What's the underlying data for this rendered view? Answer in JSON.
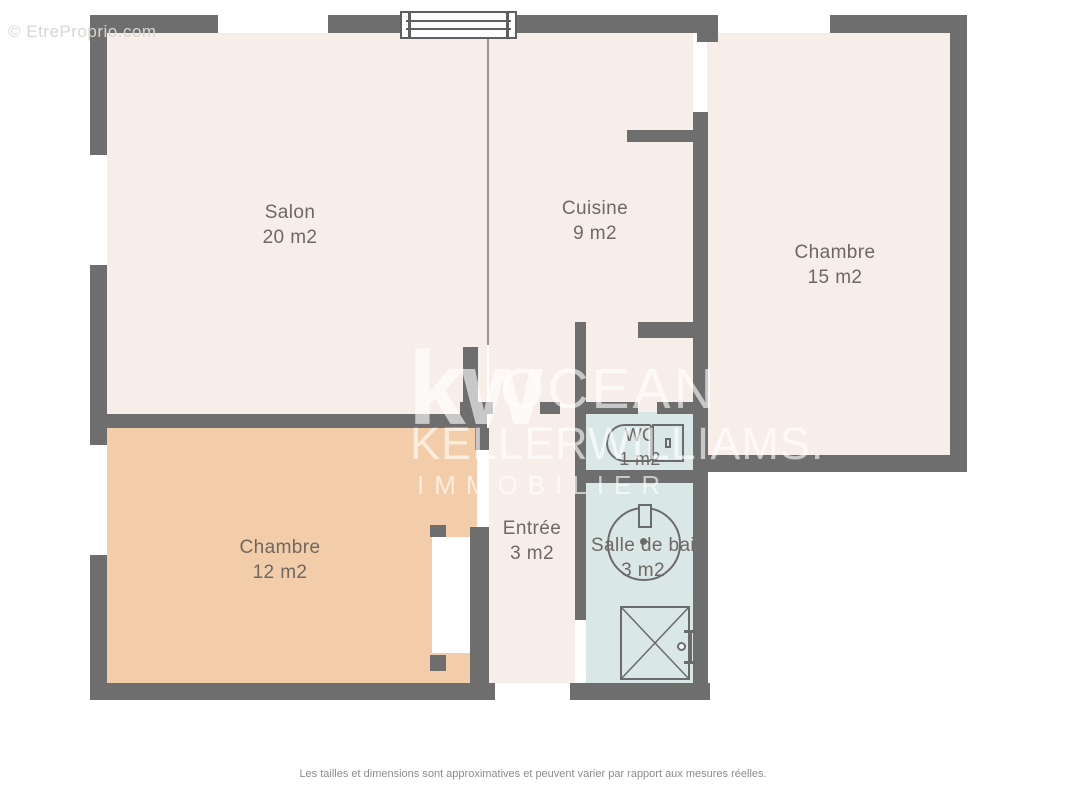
{
  "page": {
    "credit_watermark": "© EtreProprio.com",
    "disclaimer": "Les tailles et dimensions sont approximatives et peuvent varier par rapport aux mesures réelles."
  },
  "brand": {
    "kw": "kw",
    "line1": "OCEAN",
    "line2": "KELLERWILLIAMS.",
    "line3": "IMMOBILIER"
  },
  "rooms": [
    {
      "id": "salon",
      "label": "Salon",
      "area": "20 m2"
    },
    {
      "id": "cuisine",
      "label": "Cuisine",
      "area": "9 m2"
    },
    {
      "id": "chambre-15",
      "label": "Chambre",
      "area": "15 m2"
    },
    {
      "id": "chambre-12",
      "label": "Chambre",
      "area": "12 m2"
    },
    {
      "id": "entree",
      "label": "Entrée",
      "area": "3 m2"
    },
    {
      "id": "wc",
      "label": "WC",
      "area": "1 m2"
    },
    {
      "id": "salle-de-bain",
      "label": "Salle de bai",
      "area": "3 m2"
    }
  ],
  "colors": {
    "wall": "#6e6e6e",
    "room_cream": "#f8eee9",
    "room_peach": "#f3cda9",
    "room_blue": "#d9e7e6",
    "label": "#6f6862"
  }
}
